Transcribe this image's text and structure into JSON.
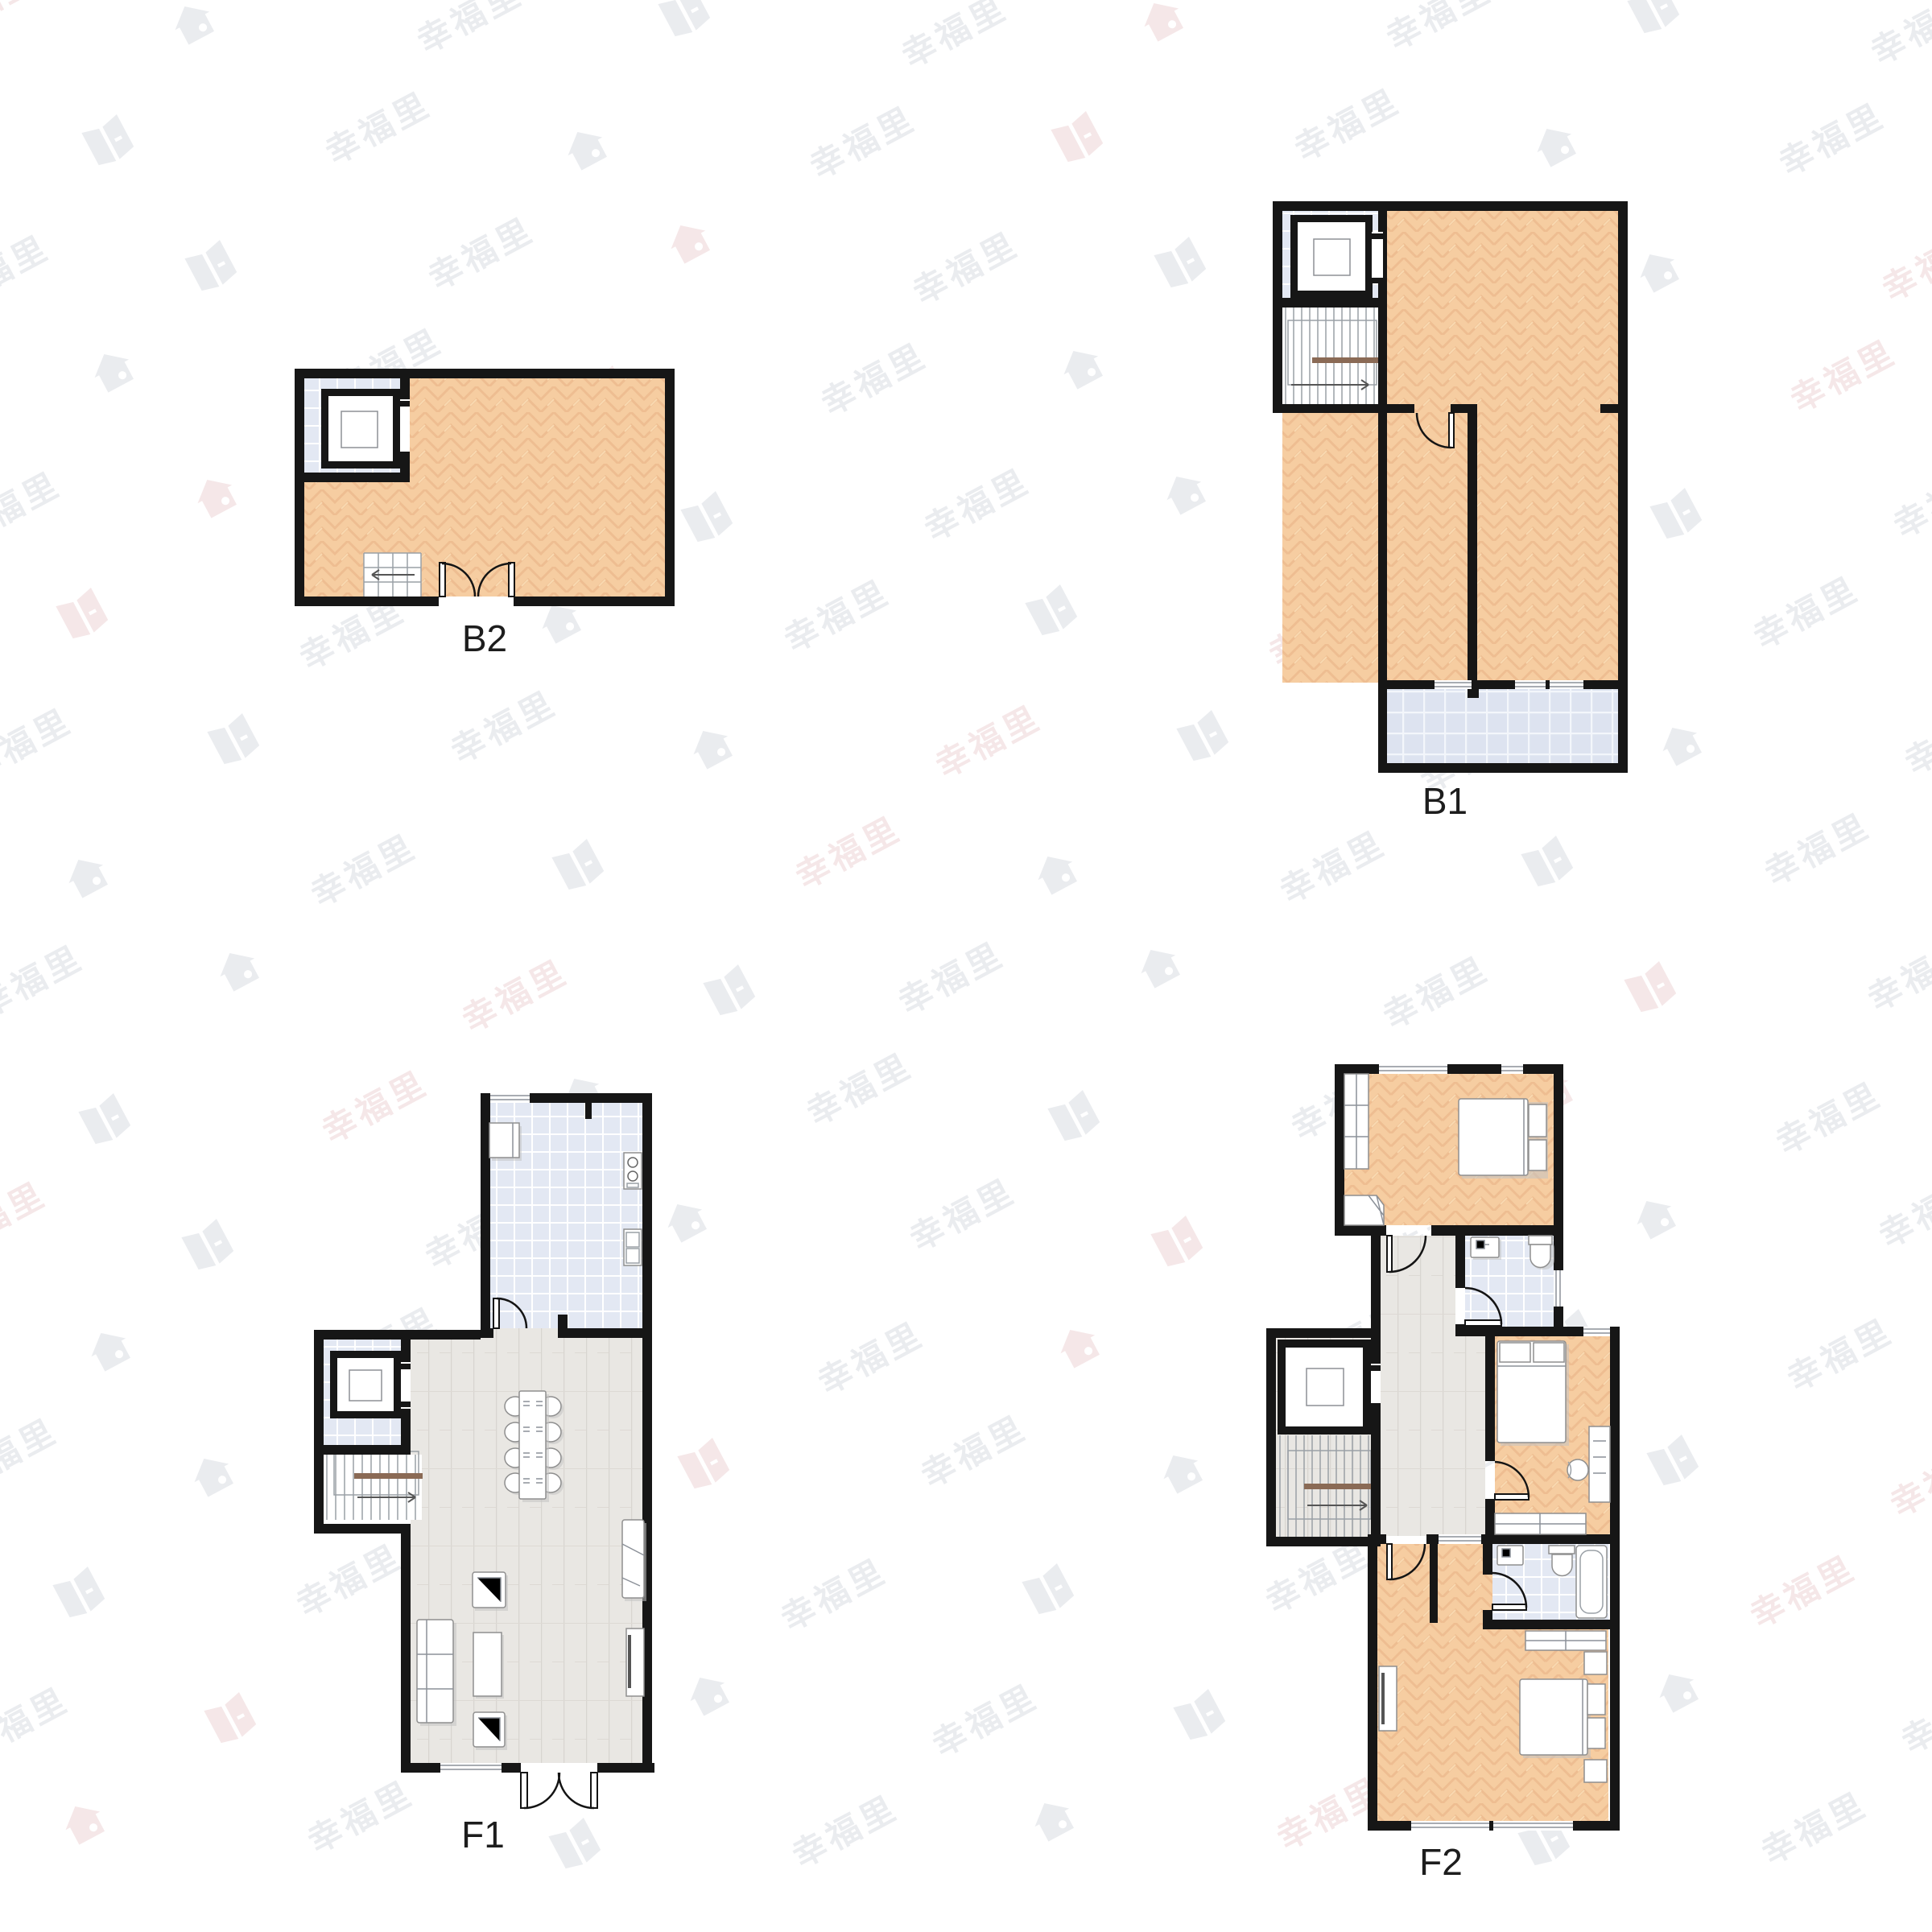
{
  "plans": {
    "b2": {
      "label": "B2"
    },
    "b1": {
      "label": "B1"
    },
    "f1": {
      "label": "F1"
    },
    "f2": {
      "label": "F2"
    }
  },
  "watermark": {
    "texts": [
      "幸福里",
      "幸福客"
    ],
    "icons": [
      "house-icon",
      "book-icon"
    ],
    "gray": "#b7bdc9",
    "pink": "#dcaaae",
    "opacity": 0.28,
    "rotation_deg": -28,
    "rows": 16,
    "cols": 9,
    "x_step": 300,
    "y_step": 150
  },
  "colors": {
    "wall": "#161616",
    "wood_floor": "#f6cda1",
    "wood_grain": "#e7b082",
    "tile_floor": "#e3e8f3",
    "balcony_tile": "#dde3f0",
    "plank_floor": "#e9e7e3",
    "stair_rail": "#8a6a55",
    "label_text": "#1d1d1d"
  }
}
